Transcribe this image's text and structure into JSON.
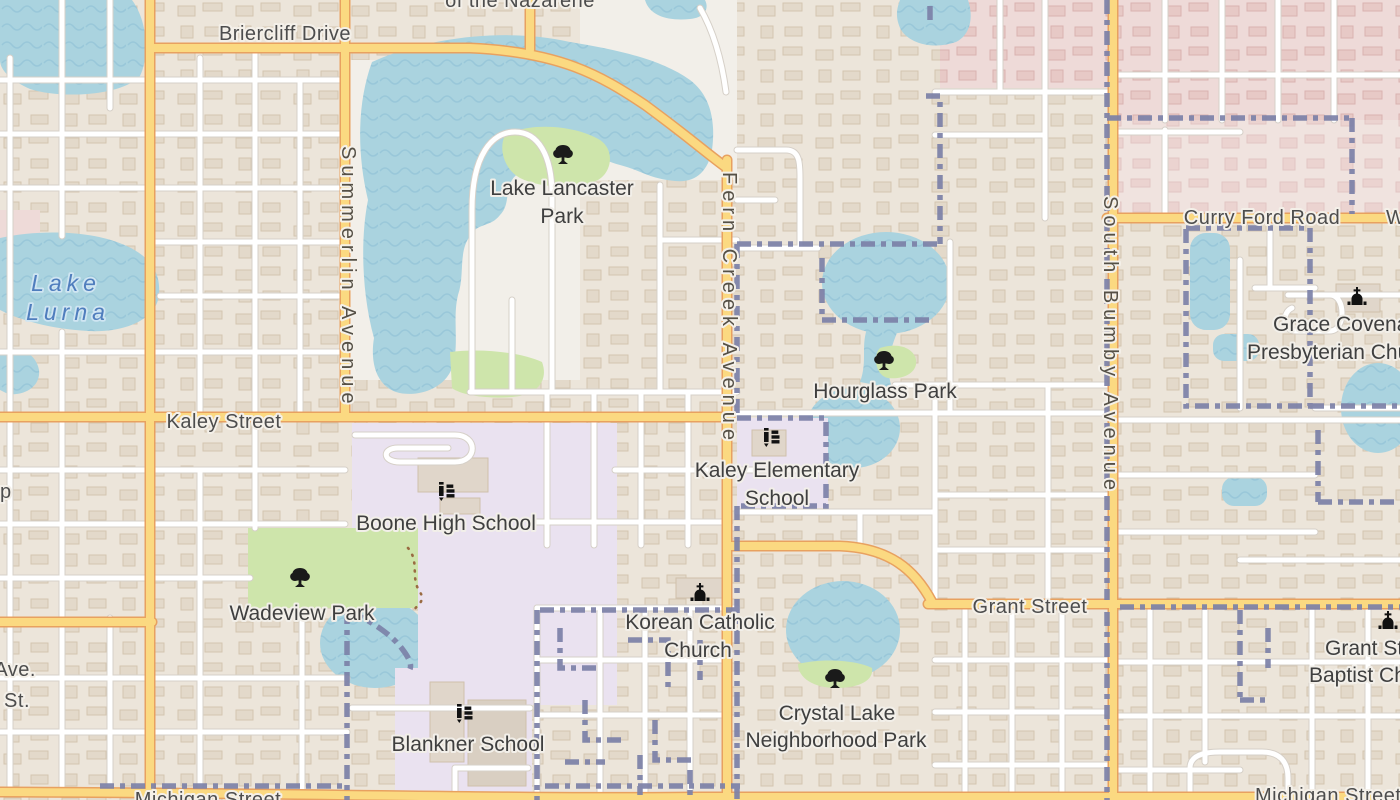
{
  "map": {
    "kind": "rendered street map tile (OpenStreetMap style)",
    "view": "Residential street grid with lakes, parks and schools"
  },
  "colors": {
    "land": "#f2efe9",
    "residential_block": "#ece5da",
    "commercial_pink": "#eedad8",
    "water": "#aad3df",
    "water_wave": "#93c3d6",
    "park_green": "#cee5ab",
    "school_lavender": "#eae2f0",
    "road_secondary_fill": "#fbd981",
    "road_secondary_casing": "#e8a160",
    "road_minor_fill": "#ffffff",
    "road_minor_casing": "#d6d0c8",
    "boundary_dash": "#7c81a8",
    "label_gray": "#4d4d4d",
    "water_label_blue": "#4f7dbd"
  },
  "labels": {
    "briercliff_drive": "Briercliff Drive",
    "top_partial": "of the Nazarene",
    "lake_lancaster_1": "Lake Lancaster",
    "lake_lancaster_2": "Park",
    "lake_lurna_1": "Lake",
    "lake_lurna_2": "Lurna",
    "summerlin_avenue": "Summerlin Avenue",
    "fern_creek_avenue": "Fern Creek Avenue",
    "south_bumby_avenue": "South Bumby Avenue",
    "kaley_street": "Kaley Street",
    "grant_street": "Grant Street",
    "curry_ford_road": "Curry Ford Road",
    "curry_ford_partial": "W",
    "hourglass_park": "Hourglass Park",
    "kaley_elementary_1": "Kaley Elementary",
    "kaley_elementary_2": "School",
    "boone_high_school": "Boone High School",
    "wadeview_park": "Wadeview Park",
    "korean_catholic_1": "Korean Catholic",
    "korean_catholic_2": "Church",
    "crystal_lake_1": "Crystal Lake",
    "crystal_lake_2": "Neighborhood Park",
    "blankner_school": "Blankner School",
    "grace_covenant_1": "Grace Covenant",
    "grace_covenant_2": "Presbyterian Church",
    "grant_baptist_1": "Grant Street",
    "grant_baptist_2": "Baptist Church",
    "michigan_street_left": "Michigan Street",
    "michigan_street_right": "Michigan Street",
    "edge_partial_ave": "Ave.",
    "edge_partial_st": "St.",
    "edge_partial_p": "p"
  },
  "poi_icons": [
    {
      "icon": "tree-icon",
      "label": "Lake Lancaster Park"
    },
    {
      "icon": "tree-icon",
      "label": "Hourglass Park"
    },
    {
      "icon": "tree-icon",
      "label": "Wadeview Park"
    },
    {
      "icon": "tree-icon",
      "label": "Crystal Lake Neighborhood Park"
    },
    {
      "icon": "school-icon",
      "label": "Boone High School"
    },
    {
      "icon": "school-icon",
      "label": "Kaley Elementary School"
    },
    {
      "icon": "school-icon",
      "label": "Blankner School"
    },
    {
      "icon": "church-icon",
      "label": "Korean Catholic Church"
    },
    {
      "icon": "church-icon",
      "label": "Grace Covenant Presbyterian Church"
    },
    {
      "icon": "church-icon",
      "label": "Grant Street Baptist Church"
    }
  ]
}
